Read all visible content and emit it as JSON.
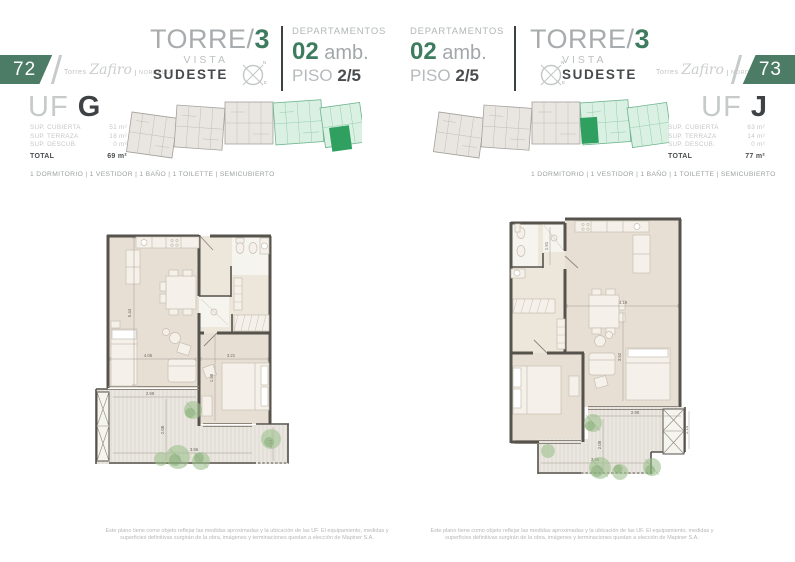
{
  "colors": {
    "accent_green": "#3e7c5f",
    "badge_green": "#4d7c66",
    "unit_highlight": "#2fa05f",
    "unit_zone": "#d9f0e2",
    "wall": "#56524c",
    "room_fill": "#e7dfd4"
  },
  "compass": {
    "n": "N",
    "e": "E"
  },
  "left_page": {
    "page_number": "72",
    "brand": {
      "prefix": "Torres",
      "script": "Zafiro",
      "suffix": "NORDELTA"
    },
    "tower": {
      "name": "TORRE/",
      "number": "3",
      "vista": "VISTA",
      "orientation": "SUDESTE"
    },
    "department": {
      "label": "DEPARTAMENTOS",
      "rooms": "02",
      "rooms_suffix": " amb.",
      "floor_label": "PISO ",
      "floor_value": "2/5"
    },
    "unit": {
      "uf": "UF ",
      "letter": "G",
      "surfaces": [
        {
          "label": "SUP. CUBIERTA",
          "value": "51 m²"
        },
        {
          "label": "SUP. TERRAZA",
          "value": "18 m²"
        },
        {
          "label": "SUP. DESCUB.",
          "value": "0 m²"
        }
      ],
      "total_label": "TOTAL",
      "total_value": "69 m²"
    },
    "features": "1 DORMITORIO | 1 VESTIDOR | 1 BAÑO | 1 TOILETTE | SEMICUBIERTO",
    "plan_dims": {
      "d1": "5.44",
      "d2": "4.06",
      "d3": "3.21",
      "d4": "2.98",
      "d5": "2.08",
      "d6": "3.96",
      "d7": "1.14",
      "d8": "1.98"
    },
    "disclaimer": "Este plano tiene como objeto reflejar las medidas aproximadas y la ubicación de las UF. El equipamiento, medidas y superficies definitivas surgirán de la obra, imágenes y terminaciones quedan a elección de Mapiner S.A."
  },
  "right_page": {
    "page_number": "73",
    "brand": {
      "prefix": "Torres",
      "script": "Zafiro",
      "suffix": "NORDELTA"
    },
    "tower": {
      "name": "TORRE/",
      "number": "3",
      "vista": "VISTA",
      "orientation": "SUDESTE"
    },
    "department": {
      "label": "DEPARTAMENTOS",
      "rooms": "02",
      "rooms_suffix": " amb.",
      "floor_label": "PISO ",
      "floor_value": "2/5"
    },
    "unit": {
      "uf": "UF ",
      "letter": "J",
      "surfaces": [
        {
          "label": "SUP. CUBIERTA",
          "value": "63 m²"
        },
        {
          "label": "SUP. TERRAZA",
          "value": "14 m²"
        },
        {
          "label": "SUP. DESCUB.",
          "value": "0 m²"
        }
      ],
      "total_label": "TOTAL",
      "total_value": "77 m²"
    },
    "features": "1 DORMITORIO | 1 VESTIDOR | 1 BAÑO | 1 TOILETTE | SEMICUBIERTO",
    "plan_dims": {
      "d1": "4.19",
      "d2": "3.52",
      "d3": "1.91",
      "d4": "2.98",
      "d5": "2.08",
      "d6": "3.96",
      "d7": "1.14"
    },
    "disclaimer": "Este plano tiene como objeto reflejar las medidas aproximadas y la ubicación de las UF. El equipamiento, medidas y superficies definitivas surgirán de la obra, imágenes y terminaciones quedan a elección de Mapiner S.A."
  }
}
